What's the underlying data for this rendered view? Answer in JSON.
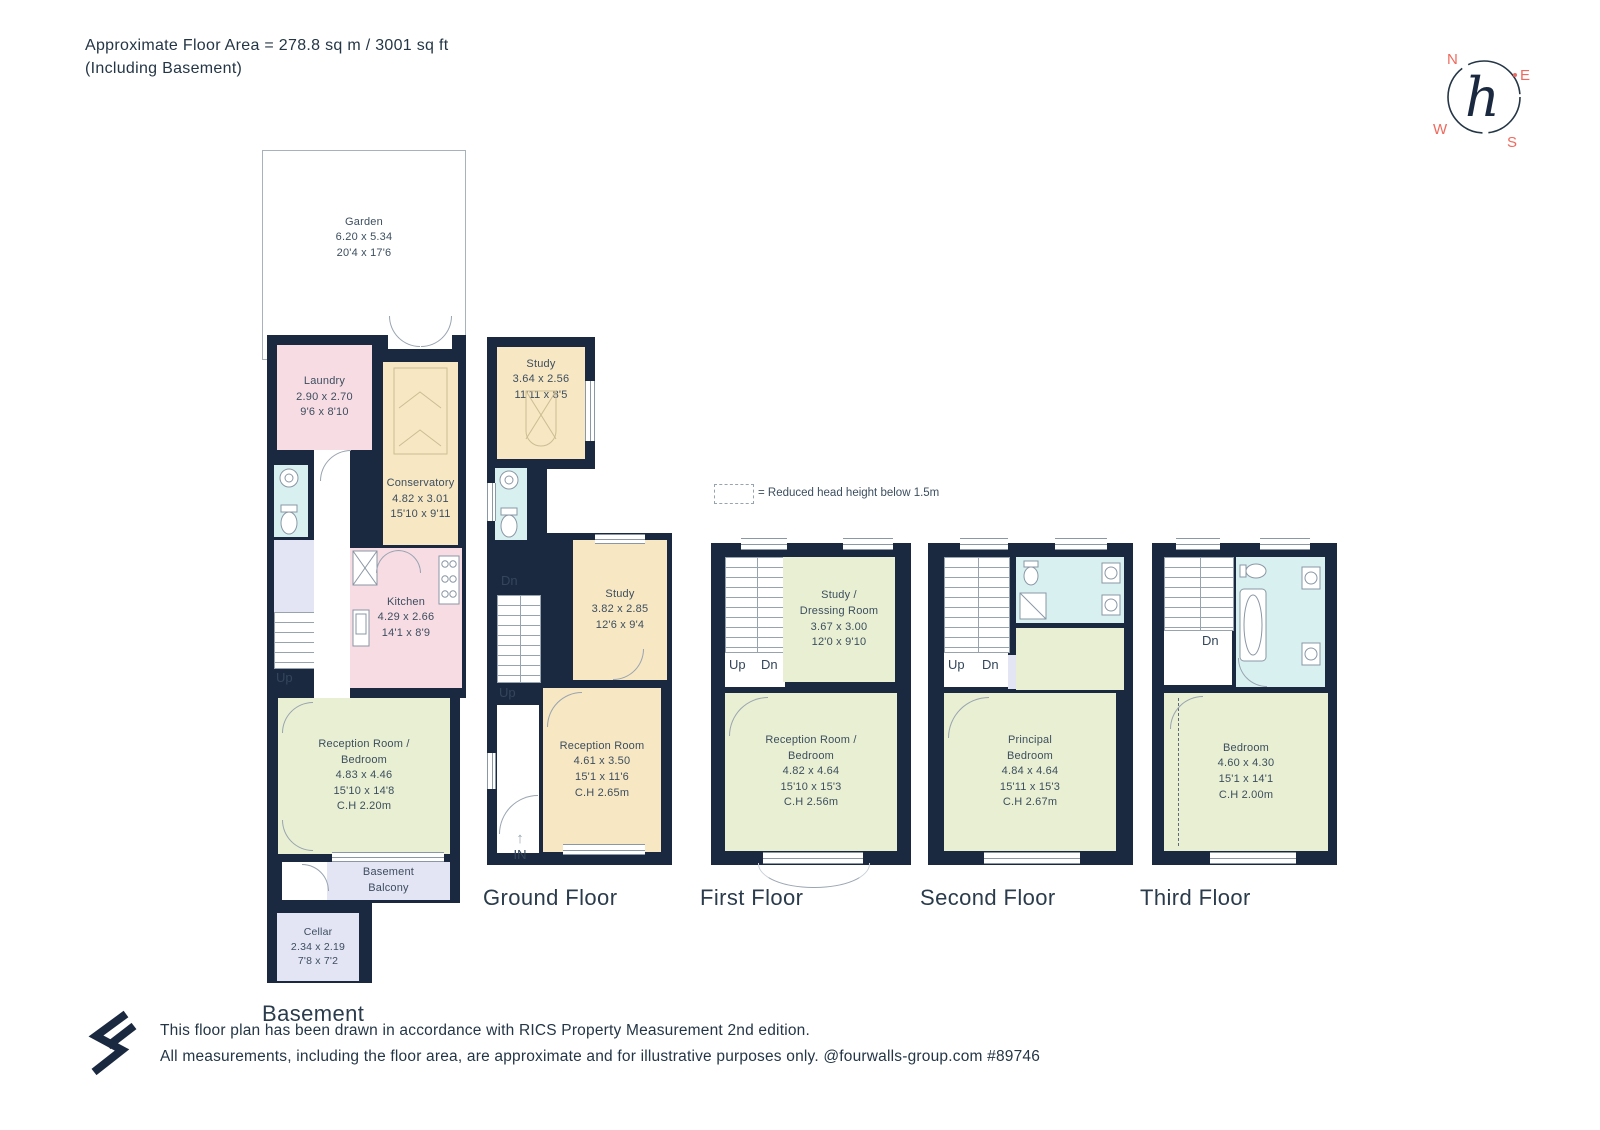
{
  "header": {
    "line1": "Approximate Floor Area = 278.8 sq m / 3001 sq ft",
    "line2": "(Including Basement)"
  },
  "compass": {
    "north": "N",
    "east": "E",
    "south": "S",
    "west": "W",
    "monogram": "h"
  },
  "legend": {
    "text": "= Reduced head height below 1.5m"
  },
  "palette": {
    "wall": "#1b2940",
    "pink": "#f8dce3",
    "cream": "#f7e7c3",
    "green": "#e9efd2",
    "cyan": "#d8f1f0",
    "lavender": "#e3e4f4",
    "compass_red": "#ef6a5e"
  },
  "floors": {
    "basement": {
      "label": "Basement",
      "stairs": {
        "up": "Up"
      },
      "rooms": {
        "garden": {
          "name": "Garden",
          "metric": "6.20 x 5.34",
          "imperial": "20'4 x 17'6"
        },
        "laundry": {
          "name": "Laundry",
          "metric": "2.90 x 2.70",
          "imperial": "9'6 x 8'10"
        },
        "conservatory": {
          "name": "Conservatory",
          "metric": "4.82 x 3.01",
          "imperial": "15'10 x 9'11"
        },
        "kitchen": {
          "name": "Kitchen",
          "metric": "4.29 x 2.66",
          "imperial": "14'1 x 8'9"
        },
        "reception": {
          "name": "Reception Room /",
          "name2": "Bedroom",
          "metric": "4.83 x 4.46",
          "imperial": "15'10 x 14'8",
          "ch": "C.H 2.20m"
        },
        "balcony": {
          "name": "Basement",
          "name2": "Balcony"
        },
        "cellar": {
          "name": "Cellar",
          "metric": "2.34 x 2.19",
          "imperial": "7'8 x 7'2"
        }
      }
    },
    "ground": {
      "label": "Ground Floor",
      "stairs": {
        "dn": "Dn",
        "up": "Up"
      },
      "entrance": {
        "label": "IN",
        "arrow": "↑"
      },
      "rooms": {
        "study_rear": {
          "name": "Study",
          "metric": "3.64 x 2.56",
          "imperial": "11'11 x 8'5"
        },
        "study": {
          "name": "Study",
          "metric": "3.82 x 2.85",
          "imperial": "12'6 x 9'4"
        },
        "reception": {
          "name": "Reception Room",
          "metric": "4.61 x 3.50",
          "imperial": "15'1 x 11'6",
          "ch": "C.H 2.65m"
        }
      }
    },
    "first": {
      "label": "First Floor",
      "stairs": {
        "up": "Up",
        "dn": "Dn"
      },
      "rooms": {
        "study": {
          "name": "Study /",
          "name2": "Dressing Room",
          "metric": "3.67 x 3.00",
          "imperial": "12'0 x 9'10"
        },
        "reception": {
          "name": "Reception Room /",
          "name2": "Bedroom",
          "metric": "4.82 x 4.64",
          "imperial": "15'10 x 15'3",
          "ch": "C.H 2.56m"
        }
      }
    },
    "second": {
      "label": "Second Floor",
      "stairs": {
        "up": "Up",
        "dn": "Dn"
      },
      "rooms": {
        "principal": {
          "name": "Principal",
          "name2": "Bedroom",
          "metric": "4.84 x 4.64",
          "imperial": "15'11 x 15'3",
          "ch": "C.H 2.67m"
        }
      }
    },
    "third": {
      "label": "Third Floor",
      "stairs": {
        "dn": "Dn"
      },
      "rooms": {
        "bedroom": {
          "name": "Bedroom",
          "metric": "4.60 x 4.30",
          "imperial": "15'1 x 14'1",
          "ch": "C.H 2.00m"
        }
      }
    }
  },
  "footer": {
    "line1": "This floor plan has been drawn in accordance with RICS Property Measurement 2nd edition.",
    "line2": "All measurements, including the floor area, are approximate and for illustrative purposes only. @fourwalls-group.com #89746"
  }
}
